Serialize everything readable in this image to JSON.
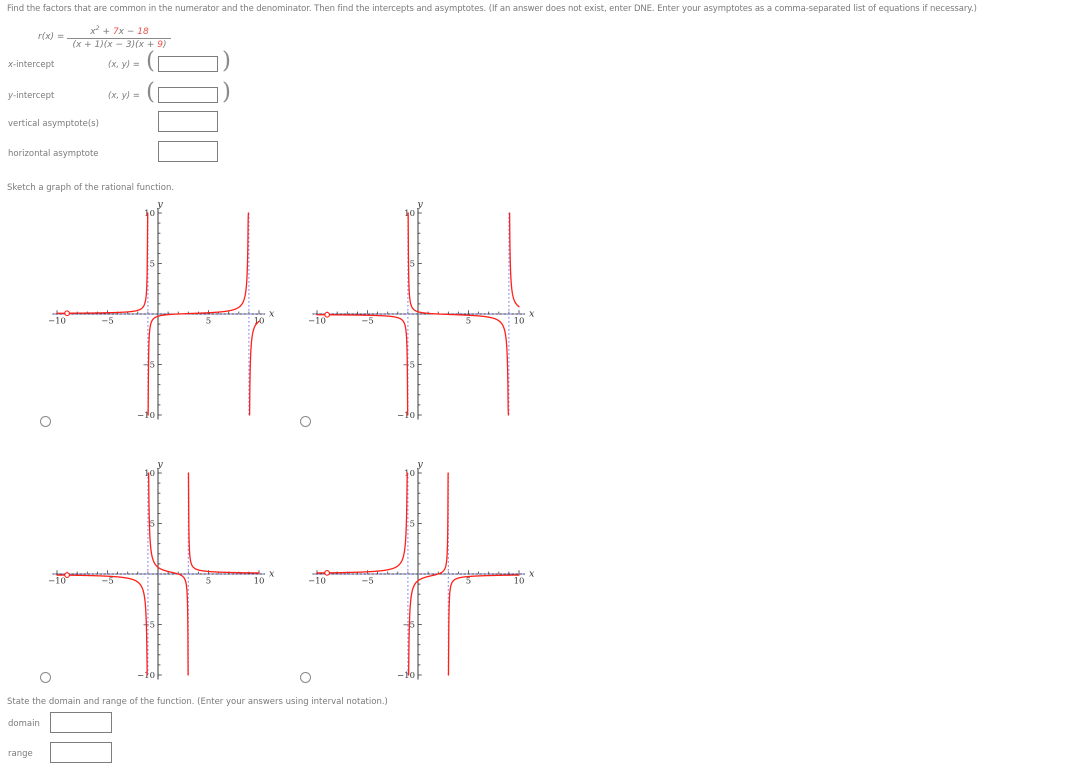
{
  "instructions": "Find the factors that are common in the numerator and the denominator. Then find the intercepts and asymptotes. (If an answer does not exist, enter DNE. Enter your asymptotes as a comma-separated list of equations if necessary.)",
  "formula": {
    "lhs": "r(x) = ",
    "num_a": "x",
    "num_sup": "2",
    "num_b": " + ",
    "num_red1": "7",
    "num_c": "x − ",
    "num_red2": "18",
    "den_a": "(x + 1)(x − 3)(x + ",
    "den_red": "9",
    "den_b": ")",
    "highlight_color": "#e8534e"
  },
  "fields": {
    "x_intercept": {
      "label_var": "x",
      "label_rest": "-intercept",
      "coord_prefix": "(x, y) = ",
      "paren_open": "(",
      "paren_close": ")",
      "value": ""
    },
    "y_intercept": {
      "label_var": "y",
      "label_rest": "-intercept",
      "coord_prefix": "(x, y) = ",
      "paren_open": "(",
      "paren_close": ")",
      "value": ""
    },
    "vertical_asymptotes": {
      "label": "vertical asymptote(s)",
      "value": ""
    },
    "horizontal_asymptote": {
      "label": "horizontal asymptote",
      "value": ""
    }
  },
  "sketch_heading": "Sketch a graph of the rational function.",
  "chart_data": {
    "type": "line",
    "shared_axes": {
      "xmin": -10,
      "xmax": 10,
      "ymin": -10,
      "ymax": 10,
      "tick_step": 1,
      "xtick_labels": [
        -10,
        -5,
        5,
        10
      ],
      "ytick_labels": [
        10,
        5,
        -5,
        -10
      ],
      "xlabel": "x",
      "ylabel": "y",
      "grid": false
    },
    "colors": {
      "curve": "#ff2018",
      "asymptote": "#8282f7",
      "axis": "#3a3a3a"
    },
    "options": [
      {
        "name": "option-a",
        "position": "top-left",
        "sign": -1,
        "zero": 2,
        "poles": [
          -1,
          9
        ],
        "vertical_asymptotes": [
          -1,
          9
        ],
        "horizontal_asymptote": 0,
        "x_intercept": 2,
        "hole_x": -9
      },
      {
        "name": "option-b",
        "position": "top-right",
        "sign": 1,
        "zero": 2,
        "poles": [
          -1,
          9
        ],
        "vertical_asymptotes": [
          -1,
          9
        ],
        "horizontal_asymptote": 0,
        "x_intercept": 2,
        "hole_x": -9
      },
      {
        "name": "option-c",
        "position": "bottom-left",
        "sign": 1,
        "zero": 2,
        "poles": [
          -1,
          3
        ],
        "vertical_asymptotes": [
          -1,
          3
        ],
        "horizontal_asymptote": 0,
        "x_intercept": 2,
        "hole_x": -9
      },
      {
        "name": "option-d",
        "position": "bottom-right",
        "sign": -1,
        "zero": 2,
        "poles": [
          -1,
          3
        ],
        "vertical_asymptotes": [
          -1,
          3
        ],
        "horizontal_asymptote": 0,
        "x_intercept": 2,
        "hole_x": -9
      }
    ]
  },
  "domain_range": {
    "heading": "State the domain and range of the function. (Enter your answers using interval notation.)",
    "domain_label": "domain",
    "range_label": "range",
    "domain_value": "",
    "range_value": ""
  }
}
